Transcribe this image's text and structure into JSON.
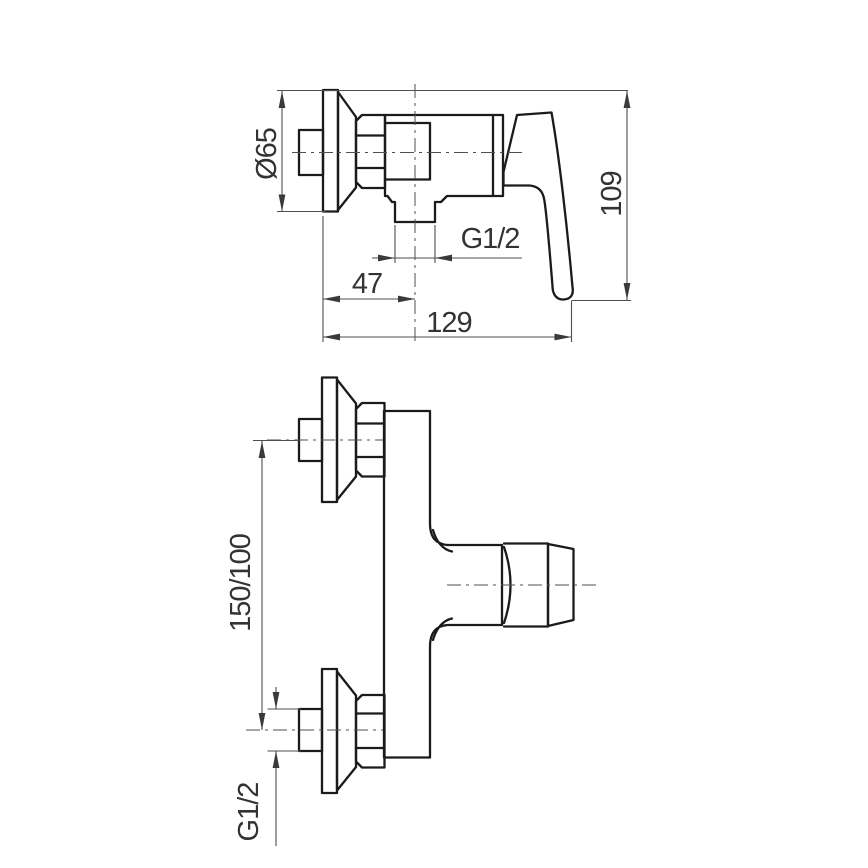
{
  "page": {
    "background": "#ffffff"
  },
  "drawing": {
    "subject": "Wall-mounted single-lever shower mixer - dimensioned outline drawing",
    "colors": {
      "outline": "#1b1b1b",
      "dimension": "#4f4f4f",
      "text": "#333333"
    },
    "side_view": {
      "labels": {
        "flange_diameter": "Ø65",
        "overall_height": "109",
        "outlet_thread": "G1/2",
        "outlet_offset": "47",
        "overall_depth": "129"
      }
    },
    "front_view": {
      "labels": {
        "connection_centers": "150/100",
        "connection_thread": "G1/2"
      }
    }
  }
}
